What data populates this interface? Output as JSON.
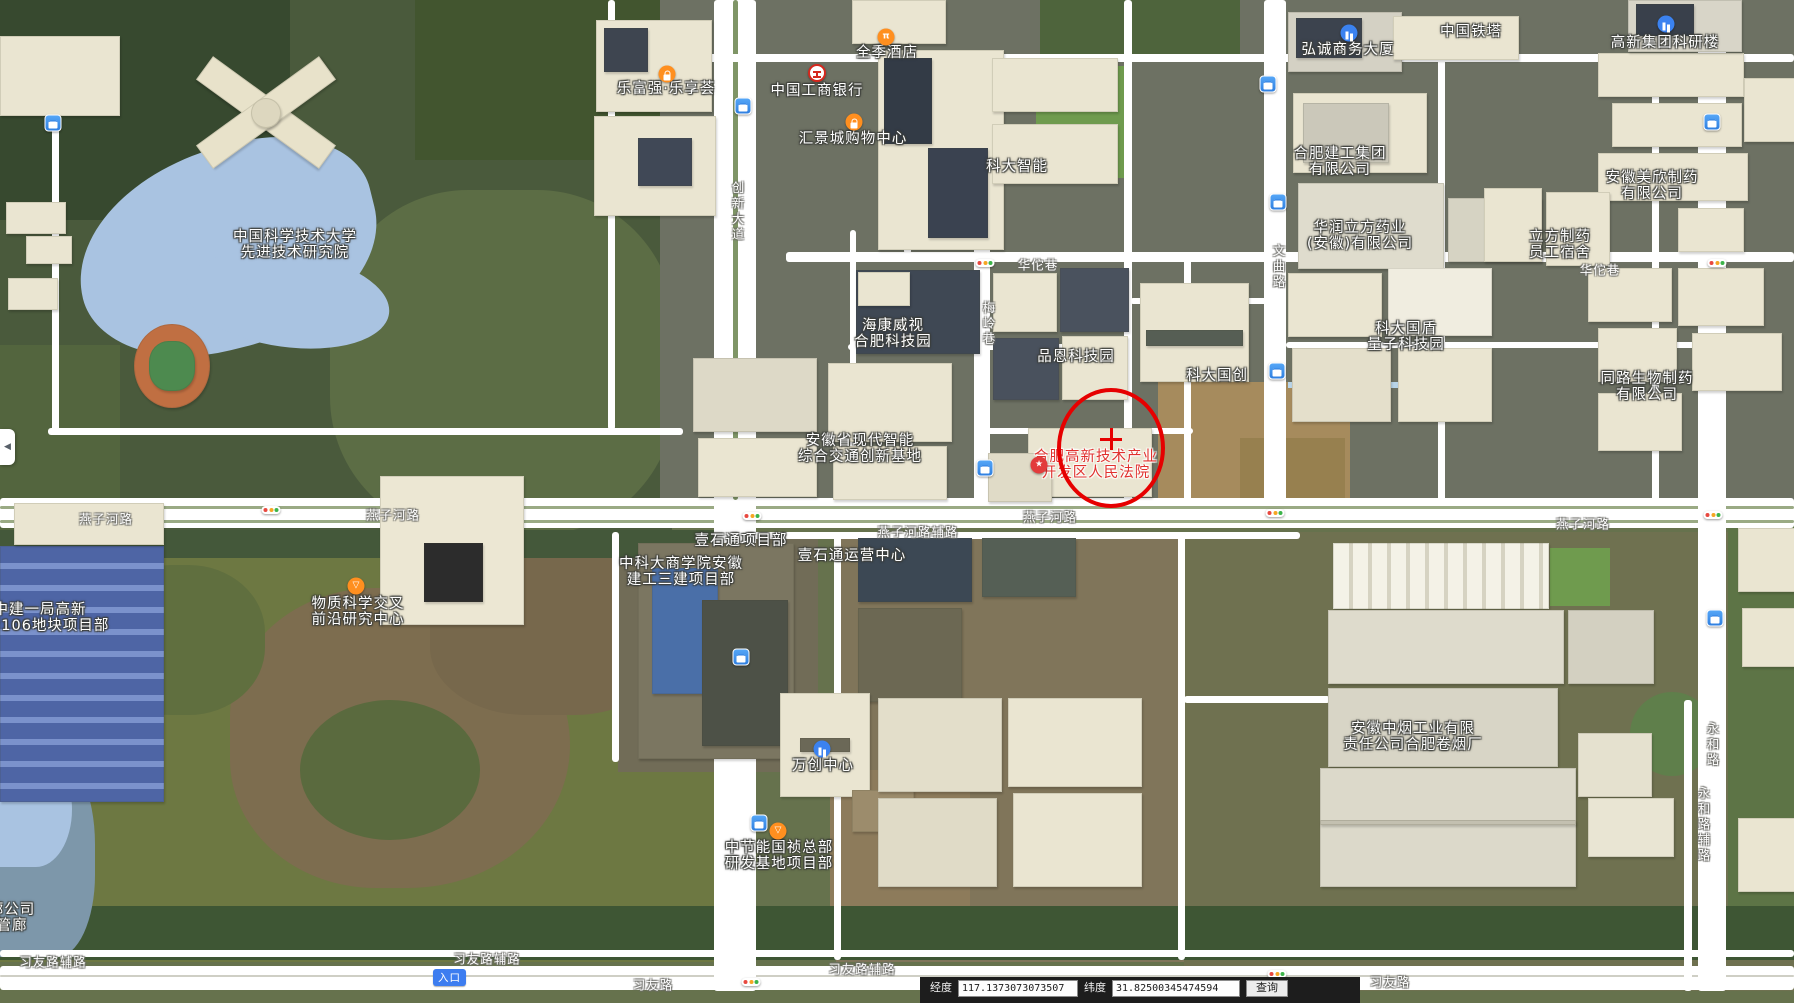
{
  "map": {
    "poi_labels": [
      {
        "name": "ustc-institute",
        "lines": [
          "中国科学技术大学",
          "先进技术研究院"
        ],
        "x": 295,
        "y": 238
      },
      {
        "name": "lefuqiang-plaza",
        "lines": [
          "乐富强·乐享荟"
        ],
        "x": 666,
        "y": 90
      },
      {
        "name": "icbc-bank",
        "lines": [
          "中国工商银行"
        ],
        "x": 817,
        "y": 92
      },
      {
        "name": "hotel-quanji",
        "lines": [
          "全季酒店"
        ],
        "x": 887,
        "y": 54
      },
      {
        "name": "huijing-mall",
        "lines": [
          "汇景城购物中心"
        ],
        "x": 853,
        "y": 140
      },
      {
        "name": "keda-intelligent",
        "lines": [
          "科大智能"
        ],
        "x": 1017,
        "y": 168
      },
      {
        "name": "china-tower",
        "lines": [
          "中国铁塔"
        ],
        "x": 1471,
        "y": 33
      },
      {
        "name": "hongcheng-tower",
        "lines": [
          "弘诚商务大厦"
        ],
        "x": 1348,
        "y": 51
      },
      {
        "name": "gaoxin-research",
        "lines": [
          "高新集团科研楼"
        ],
        "x": 1665,
        "y": 44
      },
      {
        "name": "hefei-construction",
        "lines": [
          "合肥建工集团",
          "有限公司"
        ],
        "x": 1340,
        "y": 155
      },
      {
        "name": "huarun-pharma",
        "lines": [
          "华润立方药业",
          "(安徽)有限公司"
        ],
        "x": 1360,
        "y": 229
      },
      {
        "name": "lifang-dorm",
        "lines": [
          "立方制药",
          "员工宿舍"
        ],
        "x": 1560,
        "y": 238
      },
      {
        "name": "meixin-pharma",
        "lines": [
          "安徽美欣制药",
          "有限公司"
        ],
        "x": 1652,
        "y": 179
      },
      {
        "name": "tonglu-bio",
        "lines": [
          "同路生物制药",
          "有限公司"
        ],
        "x": 1647,
        "y": 380
      },
      {
        "name": "guodun-quantum",
        "lines": [
          "科大国盾",
          "量子科技园"
        ],
        "x": 1406,
        "y": 330
      },
      {
        "name": "keda-guochuang",
        "lines": [
          "科大国创"
        ],
        "x": 1217,
        "y": 377
      },
      {
        "name": "pinen-park",
        "lines": [
          "品恩科技园"
        ],
        "x": 1076,
        "y": 358
      },
      {
        "name": "hikvision-park",
        "lines": [
          "海康威视",
          "合肥科技园"
        ],
        "x": 893,
        "y": 327
      },
      {
        "name": "traffic-innovation-base",
        "lines": [
          "安徽省现代智能",
          "综合交通创新基地"
        ],
        "x": 860,
        "y": 442
      },
      {
        "name": "hightech-court",
        "lines": [
          "合肥高新技术产业",
          "开发区人民法院"
        ],
        "x": 1096,
        "y": 458,
        "color": "#e0312e"
      },
      {
        "name": "material-science-center",
        "lines": [
          "物质科学交叉",
          "前沿研究中心"
        ],
        "x": 358,
        "y": 605
      },
      {
        "name": "zhongjian-project",
        "lines": [
          "中建一局高新",
          "202106地块项目部"
        ],
        "x": 40,
        "y": 611
      },
      {
        "name": "yishitong-project",
        "lines": [
          "壹石通项目部"
        ],
        "x": 741,
        "y": 542
      },
      {
        "name": "yishitong-center",
        "lines": [
          "壹石通运营中心"
        ],
        "x": 852,
        "y": 557
      },
      {
        "name": "ustc-business-school",
        "lines": [
          "中科大商学院安徽",
          "建工三建项目部"
        ],
        "x": 681,
        "y": 565
      },
      {
        "name": "wanchuang-center",
        "lines": [
          "万创中心"
        ],
        "x": 823,
        "y": 767
      },
      {
        "name": "zhongjieneng-base",
        "lines": [
          "中节能国祯总部",
          "研发基地项目部"
        ],
        "x": 779,
        "y": 849
      },
      {
        "name": "tobacco-factory",
        "lines": [
          "安徽中烟工业有限",
          "责任公司合肥卷烟厂"
        ],
        "x": 1413,
        "y": 730
      },
      {
        "name": "pipe-company",
        "lines": [
          "廊公司",
          "管廊"
        ],
        "x": 12,
        "y": 911
      }
    ],
    "road_labels": [
      {
        "text": "燕子河路",
        "x": 106,
        "y": 518
      },
      {
        "text": "燕子河路",
        "x": 393,
        "y": 514
      },
      {
        "text": "燕子河路",
        "x": 1050,
        "y": 516
      },
      {
        "text": "燕子河路",
        "x": 1583,
        "y": 523
      },
      {
        "text": "燕子河路辅路",
        "x": 918,
        "y": 531
      },
      {
        "text": "华佗巷",
        "x": 1038,
        "y": 264
      },
      {
        "text": "华佗巷",
        "x": 1600,
        "y": 269
      },
      {
        "text": "习友路",
        "x": 653,
        "y": 984
      },
      {
        "text": "习友路",
        "x": 1390,
        "y": 981
      },
      {
        "text": "习友路辅路",
        "x": 53,
        "y": 961
      },
      {
        "text": "习友路辅路",
        "x": 487,
        "y": 958
      },
      {
        "text": "习友路辅路",
        "x": 862,
        "y": 968
      }
    ],
    "road_labels_vertical": [
      {
        "text": "创新大道",
        "x": 737,
        "y": 212
      },
      {
        "text": "梅岭巷",
        "x": 988,
        "y": 324
      },
      {
        "text": "文曲路",
        "x": 1278,
        "y": 267
      },
      {
        "text": "永和路",
        "x": 1712,
        "y": 745
      },
      {
        "text": "永和路辅路",
        "x": 1703,
        "y": 825
      }
    ],
    "icons": [
      {
        "type": "bus",
        "x": 53,
        "y": 123
      },
      {
        "type": "bus",
        "x": 743,
        "y": 106
      },
      {
        "type": "bus",
        "x": 1268,
        "y": 84
      },
      {
        "type": "bus",
        "x": 1712,
        "y": 122
      },
      {
        "type": "bus",
        "x": 1278,
        "y": 202
      },
      {
        "type": "bus",
        "x": 985,
        "y": 468
      },
      {
        "type": "bus",
        "x": 741,
        "y": 657
      },
      {
        "type": "bus",
        "x": 759,
        "y": 823
      },
      {
        "type": "bus",
        "x": 1715,
        "y": 618
      },
      {
        "type": "bus",
        "x": 1277,
        "y": 371
      },
      {
        "type": "traffic",
        "x": 985,
        "y": 263
      },
      {
        "type": "traffic",
        "x": 1717,
        "y": 263
      },
      {
        "type": "traffic",
        "x": 271,
        "y": 510
      },
      {
        "type": "traffic",
        "x": 752,
        "y": 516
      },
      {
        "type": "traffic",
        "x": 1275,
        "y": 513
      },
      {
        "type": "traffic",
        "x": 1713,
        "y": 515
      },
      {
        "type": "traffic",
        "x": 751,
        "y": 982
      },
      {
        "type": "traffic",
        "x": 1277,
        "y": 974
      },
      {
        "type": "shop",
        "x": 667,
        "y": 74
      },
      {
        "type": "shop",
        "x": 854,
        "y": 122
      },
      {
        "type": "hotel",
        "x": 886,
        "y": 37
      },
      {
        "type": "bank",
        "x": 817,
        "y": 73
      },
      {
        "type": "building",
        "x": 1349,
        "y": 33
      },
      {
        "type": "building",
        "x": 1666,
        "y": 24
      },
      {
        "type": "building",
        "x": 822,
        "y": 749
      },
      {
        "type": "star",
        "x": 1039,
        "y": 465
      },
      {
        "type": "flask",
        "x": 356,
        "y": 586
      },
      {
        "type": "flask",
        "x": 778,
        "y": 831
      }
    ],
    "marker": {
      "cx": 1107,
      "cy": 444,
      "rx": 50,
      "ry": 56,
      "cross_x": 1111,
      "cross_y": 439,
      "color": "#e60000"
    },
    "entrance_badge": {
      "text": "入口",
      "x": 433,
      "y": 969
    }
  },
  "colors": {
    "bus_blue": "#3c8cec",
    "poi_orange": "#ff8f1f",
    "poi_blue": "#3b82f0",
    "poi_red": "#e23c3c",
    "marker_red": "#e60000",
    "road_white": "#ffffff"
  },
  "ui": {
    "panel_collapse_arrow": "◀",
    "coord_bar": {
      "lng_label": "经度",
      "lng_value": "117.1373073073507",
      "lat_label": "纬度",
      "lat_value": "31.82500345474594",
      "query_label": "查询"
    }
  }
}
